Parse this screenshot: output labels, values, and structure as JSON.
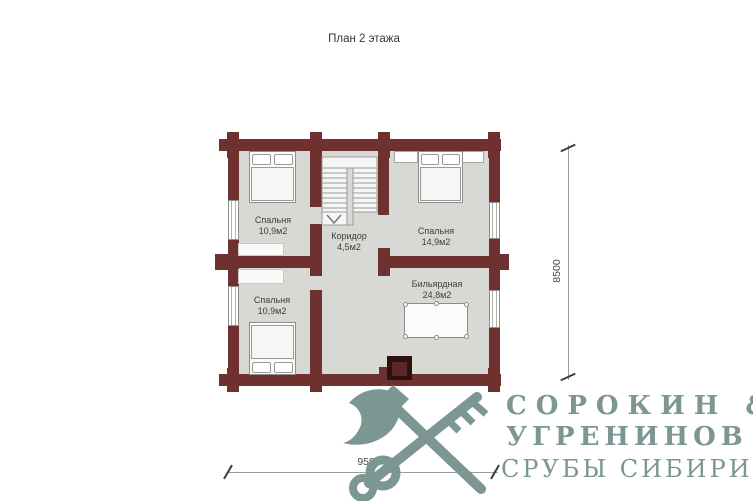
{
  "title": "План 2 этажа",
  "plan": {
    "rooms": [
      {
        "name": "Спальня",
        "area": "10,9м2"
      },
      {
        "name": "Коридор",
        "area": "4,5м2"
      },
      {
        "name": "Спальня",
        "area": "14,9м2"
      },
      {
        "name": "Спальня",
        "area": "10,9м2"
      },
      {
        "name": "Бильярдная",
        "area": "24,8м2"
      }
    ],
    "colors": {
      "wall": "#6e3130",
      "floor": "#d8d8d4",
      "fireplace_outer": "#2d1112",
      "fireplace_inner": "#5b2727"
    }
  },
  "dimensions": {
    "height": "8500",
    "width": "9500"
  },
  "logo": {
    "line1": "СОРОКИН &",
    "line2": "УГРЕНИНОВ",
    "line3": "СРУБЫ СИБИРИ",
    "color": "#7b9693",
    "icon": "crossed-axe-key-icon"
  }
}
